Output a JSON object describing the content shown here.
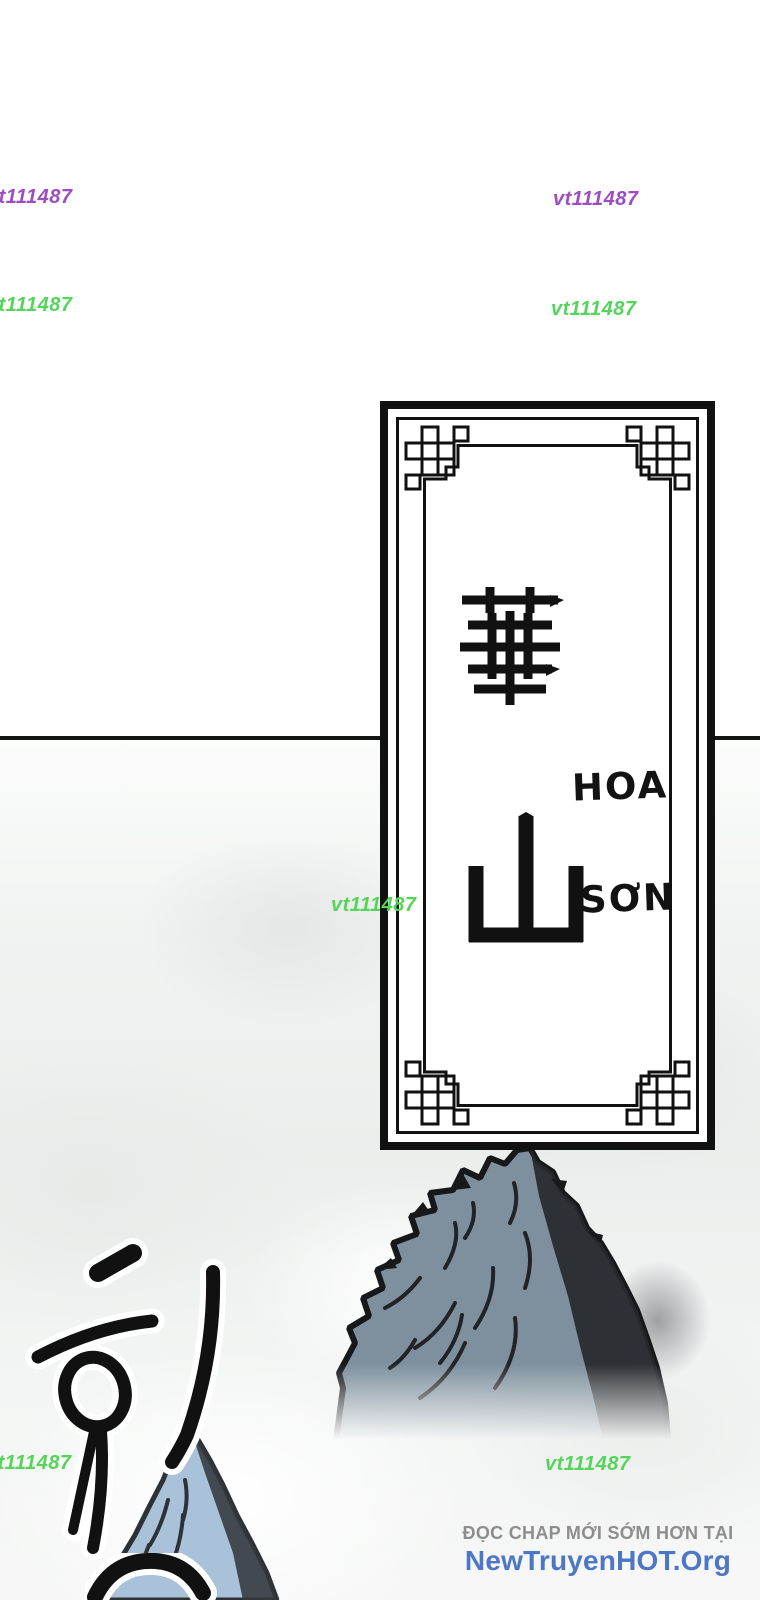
{
  "watermark": {
    "text": "vt111487",
    "purple_color": "#9d4cc1",
    "green_color": "#55d45a"
  },
  "plaque": {
    "hanja": "華山",
    "char_top": "華",
    "char_bottom": "山",
    "viet_top": "HOA",
    "viet_bottom": "SƠN"
  },
  "sfx": {
    "korean": "휘"
  },
  "footer": {
    "tagline": "ĐỌC CHAP MỚI SỚM HƠN TẠI",
    "site_name": "NewTruyenHOT.Org",
    "tagline_color": "#8d8d8d",
    "site_color": "#4d76c6"
  },
  "colors": {
    "ink": "#17181a",
    "mountain_slate": "#7e909d",
    "mountain_shadow": "#26292d",
    "small_peak_blue": "#a9c2da",
    "mist_gray": "#eceeec",
    "panel_line": "#141414"
  }
}
